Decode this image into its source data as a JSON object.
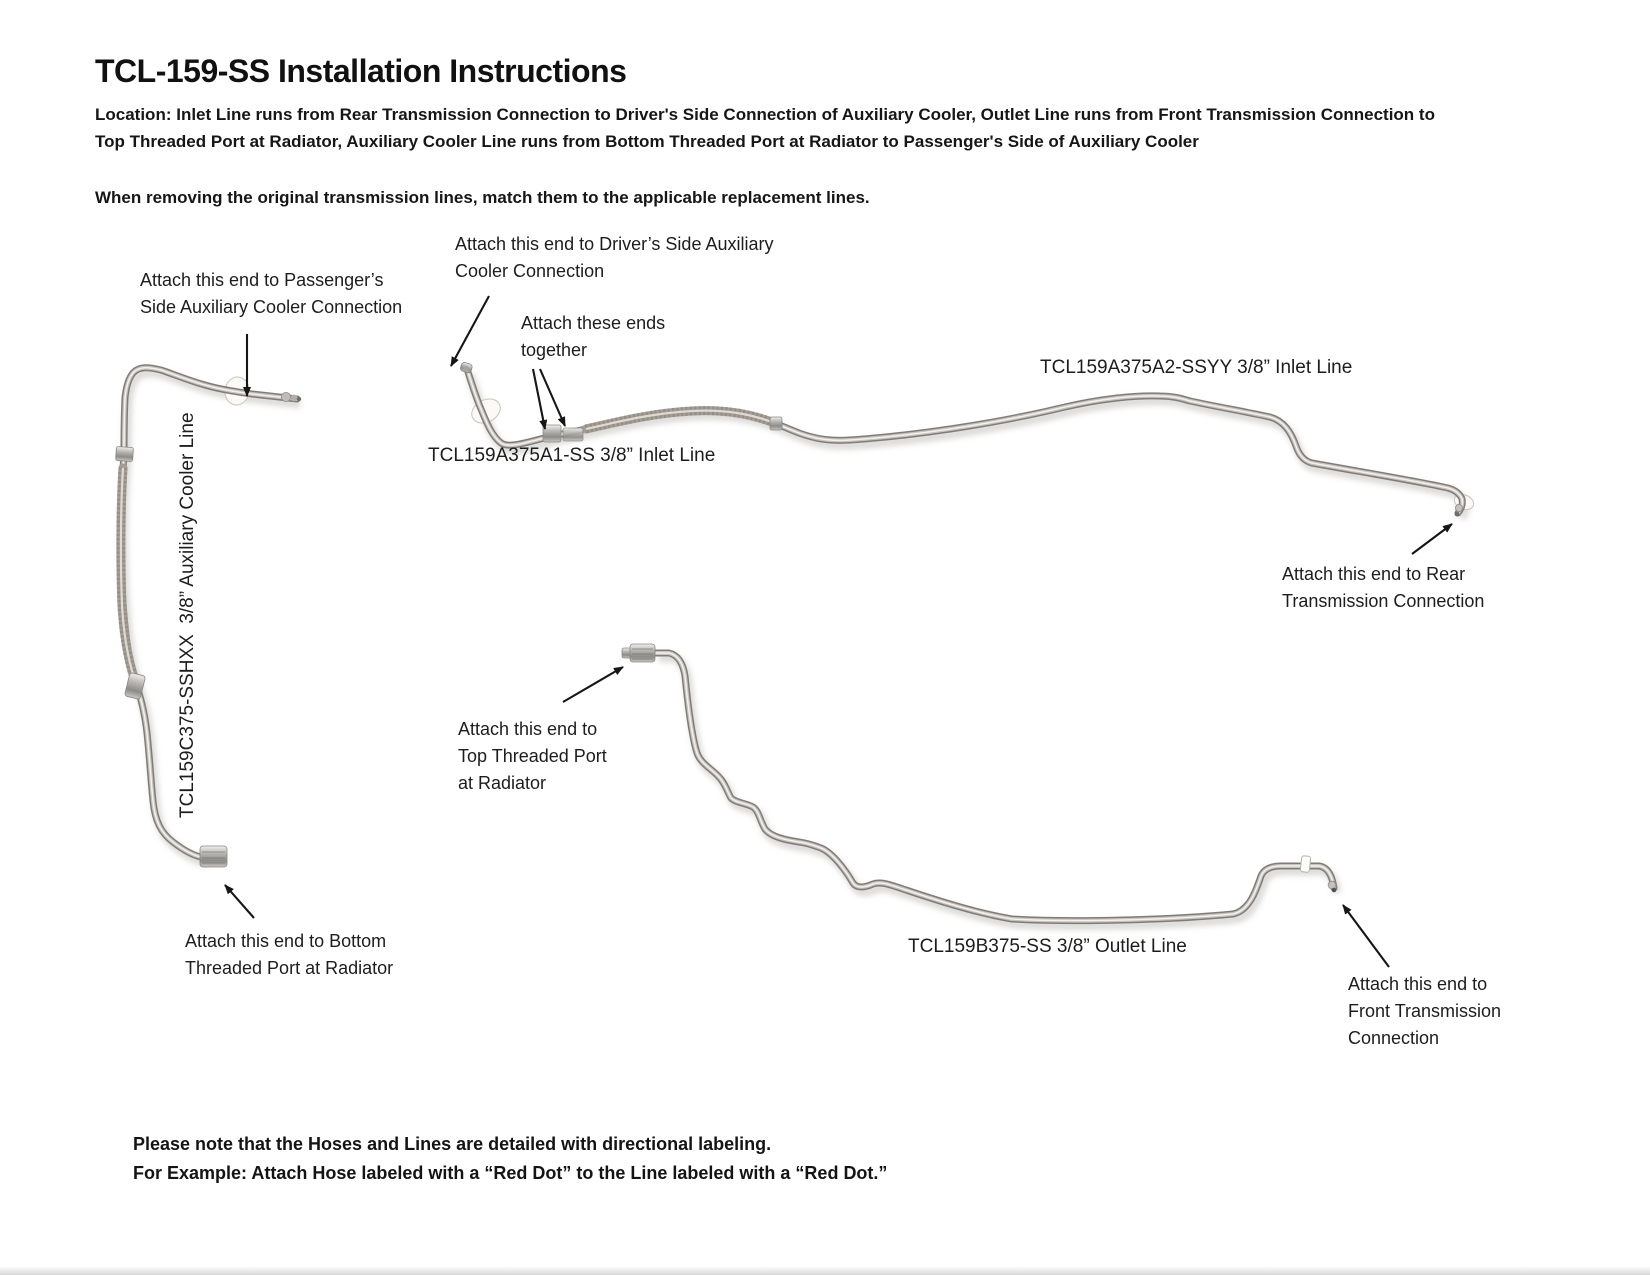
{
  "header": {
    "title": "TCL-159-SS Installation Instructions",
    "location": "Location: Inlet Line runs from Rear Transmission Connection to Driver's Side Connection of Auxiliary Cooler, Outlet Line runs from Front Transmission Connection to Top Threaded Port at Radiator, Auxiliary Cooler Line runs from Bottom Threaded Port at Radiator to Passenger's Side of Auxiliary Cooler",
    "removal_note": "When removing the original transmission lines, match them to the applicable replacement lines."
  },
  "diagram": {
    "labels": {
      "aux_line": "TCL159C375-SSHXX  3/8” Auxiliary Cooler Line",
      "inlet_a1": "TCL159A375A1-SS 3/8” Inlet Line",
      "inlet_a2": "TCL159A375A2-SSYY 3/8” Inlet Line",
      "outlet_b": "TCL159B375-SS 3/8” Outlet Line"
    },
    "annotations": {
      "passenger": [
        "Attach this end to Passenger’s",
        "Side Auxiliary Cooler Connection"
      ],
      "driver": [
        "Attach this end to Driver’s Side Auxiliary",
        "Cooler Connection"
      ],
      "together": [
        "Attach these ends",
        "together"
      ],
      "rear": [
        "Attach this end to Rear",
        "Transmission Connection"
      ],
      "top_port": [
        "Attach this end to",
        "Top Threaded Port",
        "at Radiator"
      ],
      "bottom_port": [
        "Attach this end to Bottom",
        "Threaded Port at Radiator"
      ],
      "front": [
        "Attach this end to",
        "Front Transmission",
        "Connection"
      ]
    }
  },
  "footer": {
    "note1": "Please note that the Hoses and Lines are detailed with directional labeling.",
    "note2": "For Example: Attach Hose labeled with a “Red Dot” to the Line labeled with a “Red Dot.”"
  },
  "colors": {
    "text": "#1d1d1d",
    "tube_dark": "#807d79",
    "tube_mid": "#c6c3be",
    "tube_highlight": "#f3f1ee",
    "braid": "#a39d95",
    "arrow": "#161616",
    "background": "#ffffff"
  }
}
